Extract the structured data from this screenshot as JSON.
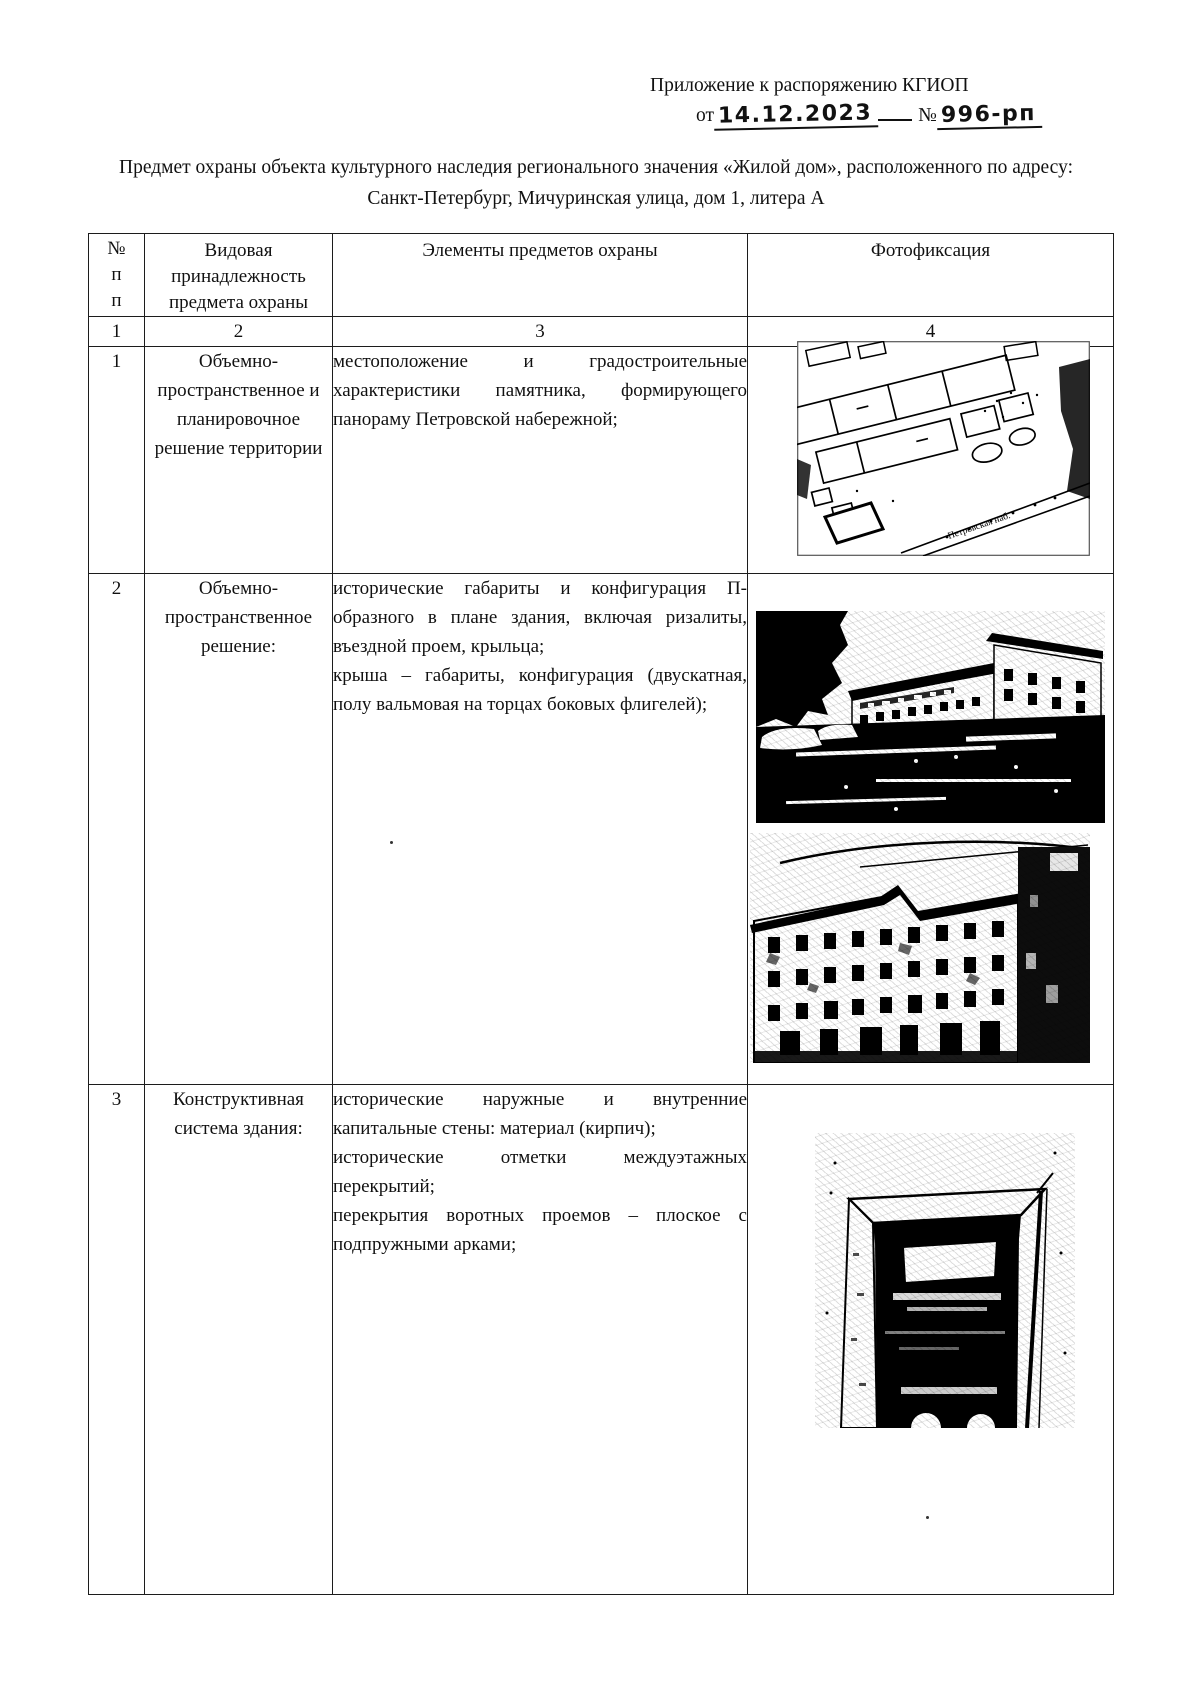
{
  "header": {
    "line1": "Приложение к распоряжению КГИОП",
    "date_prefix": "от",
    "date_value": "14.12.2023",
    "number_prefix": "№",
    "number_value": "996-рп"
  },
  "title": "Предмет охраны объекта культурного наследия регионального значения «Жилой дом», расположенного по адресу: Санкт-Петербург, Мичуринская улица, дом 1, литера А",
  "table": {
    "headers": {
      "col1_lines": [
        "№",
        "п",
        "п"
      ],
      "col2": "Видовая принадлежность предмета охраны",
      "col3": "Элементы предметов охраны",
      "col4": "Фотофиксация"
    },
    "numbering": [
      "1",
      "2",
      "3",
      "4"
    ],
    "rows": [
      {
        "num": "1",
        "category": "Объемно-пространственное и планировочное решение территории",
        "elements": [
          "местоположение и градостроительные характеристики памятника, формирующего панораму Петровской набережной;"
        ],
        "photo_names": [
          "site-plan-image"
        ],
        "map_label": "Петровская наб."
      },
      {
        "num": "2",
        "category": "Объемно-пространственное решение:",
        "elements": [
          "исторические габариты и конфигурация П-образного в плане здания, включая ризалиты, въездной проем, крыльца;",
          "крыша – габариты, конфигурация (двускатная, полу вальмовая на торцах боковых флигелей);"
        ],
        "photo_names": [
          "street-panorama-image",
          "courtyard-facade-image"
        ]
      },
      {
        "num": "3",
        "category": "Конструктивная система здания:",
        "elements": [
          "исторические наружные и внутренние капитальные стены: материал (кирпич);",
          "исторические отметки междуэтажных перекрытий;",
          "перекрытия воротных проемов – плоское с подпружными арками;"
        ],
        "photo_names": [
          "gateway-arch-image"
        ]
      }
    ]
  }
}
